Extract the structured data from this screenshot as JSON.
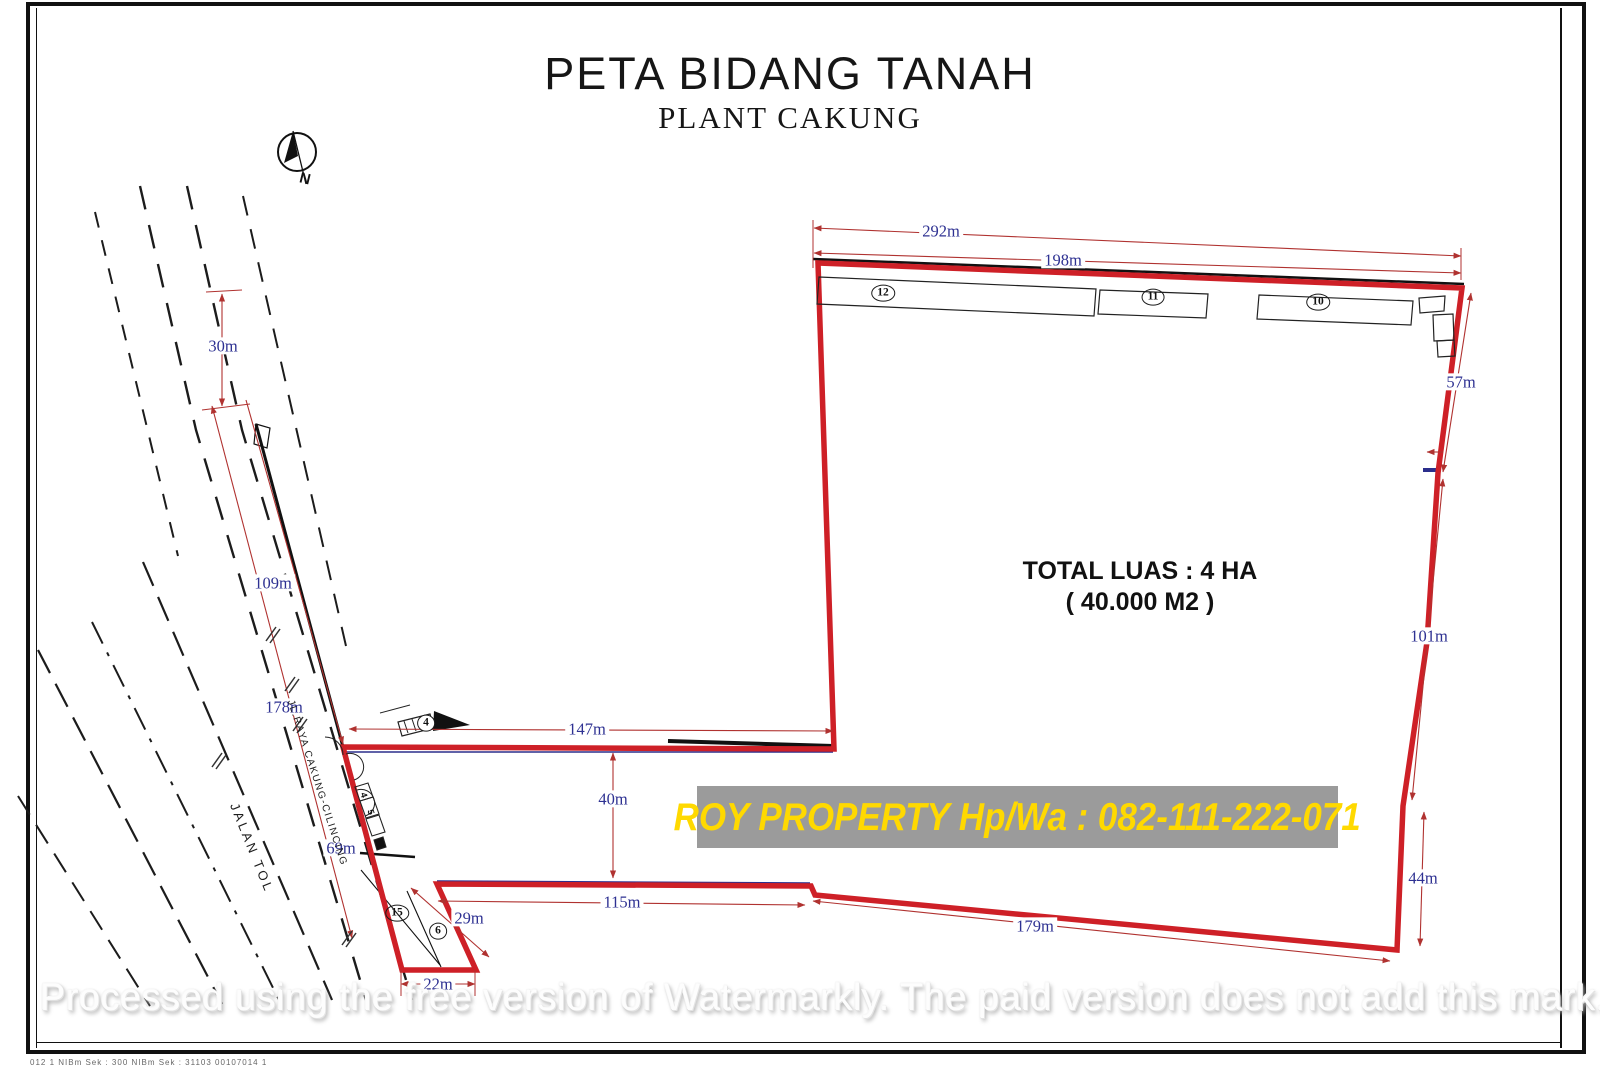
{
  "title": {
    "main": "PETA BIDANG TANAH",
    "sub": "PLANT CAKUNG"
  },
  "compass": {
    "label": "N"
  },
  "area_note": {
    "line1": "TOTAL LUAS : 4 HA",
    "line2": "( 40.000 M2 )"
  },
  "banner": {
    "text": "ROY PROPERTY Hp/Wa : 082-111-222-071"
  },
  "watermark": {
    "text": "Processed using the free version of Watermarkly. The paid version does not add this mark."
  },
  "roads": {
    "toll_road": "JALAN TOL",
    "main_road": "JL.RAYA CAKUNG-CILINCING"
  },
  "dimensions": {
    "top_total": "292m",
    "top_partial": "198m",
    "right_upper": "57m",
    "right_middle": "101m",
    "right_lower": "44m",
    "bottom_diagonal": "179m",
    "bottom_middle": "115m",
    "spur_side": "29m",
    "spur_bottom": "22m",
    "inner_width": "147m",
    "inner_height": "40m",
    "road_top": "30m",
    "road_upper": "109m",
    "road_middle": "178m",
    "road_lower": "69m"
  },
  "parcels": {
    "p12": "12",
    "p11": "11",
    "p10": "10",
    "p4": "4",
    "p15": "15",
    "p6": "6",
    "unit_a": "4",
    "unit_b": "5"
  },
  "footer_note": "012 1 NIBm    Sek : 300 NIBm    Sek : 31103 00107014 1",
  "colors": {
    "boundary": "#ce2027",
    "dim_line": "#b03230",
    "dim_text": "#2e3192",
    "banner_bg": "#9b9b9b",
    "banner_text": "#ffd900"
  }
}
